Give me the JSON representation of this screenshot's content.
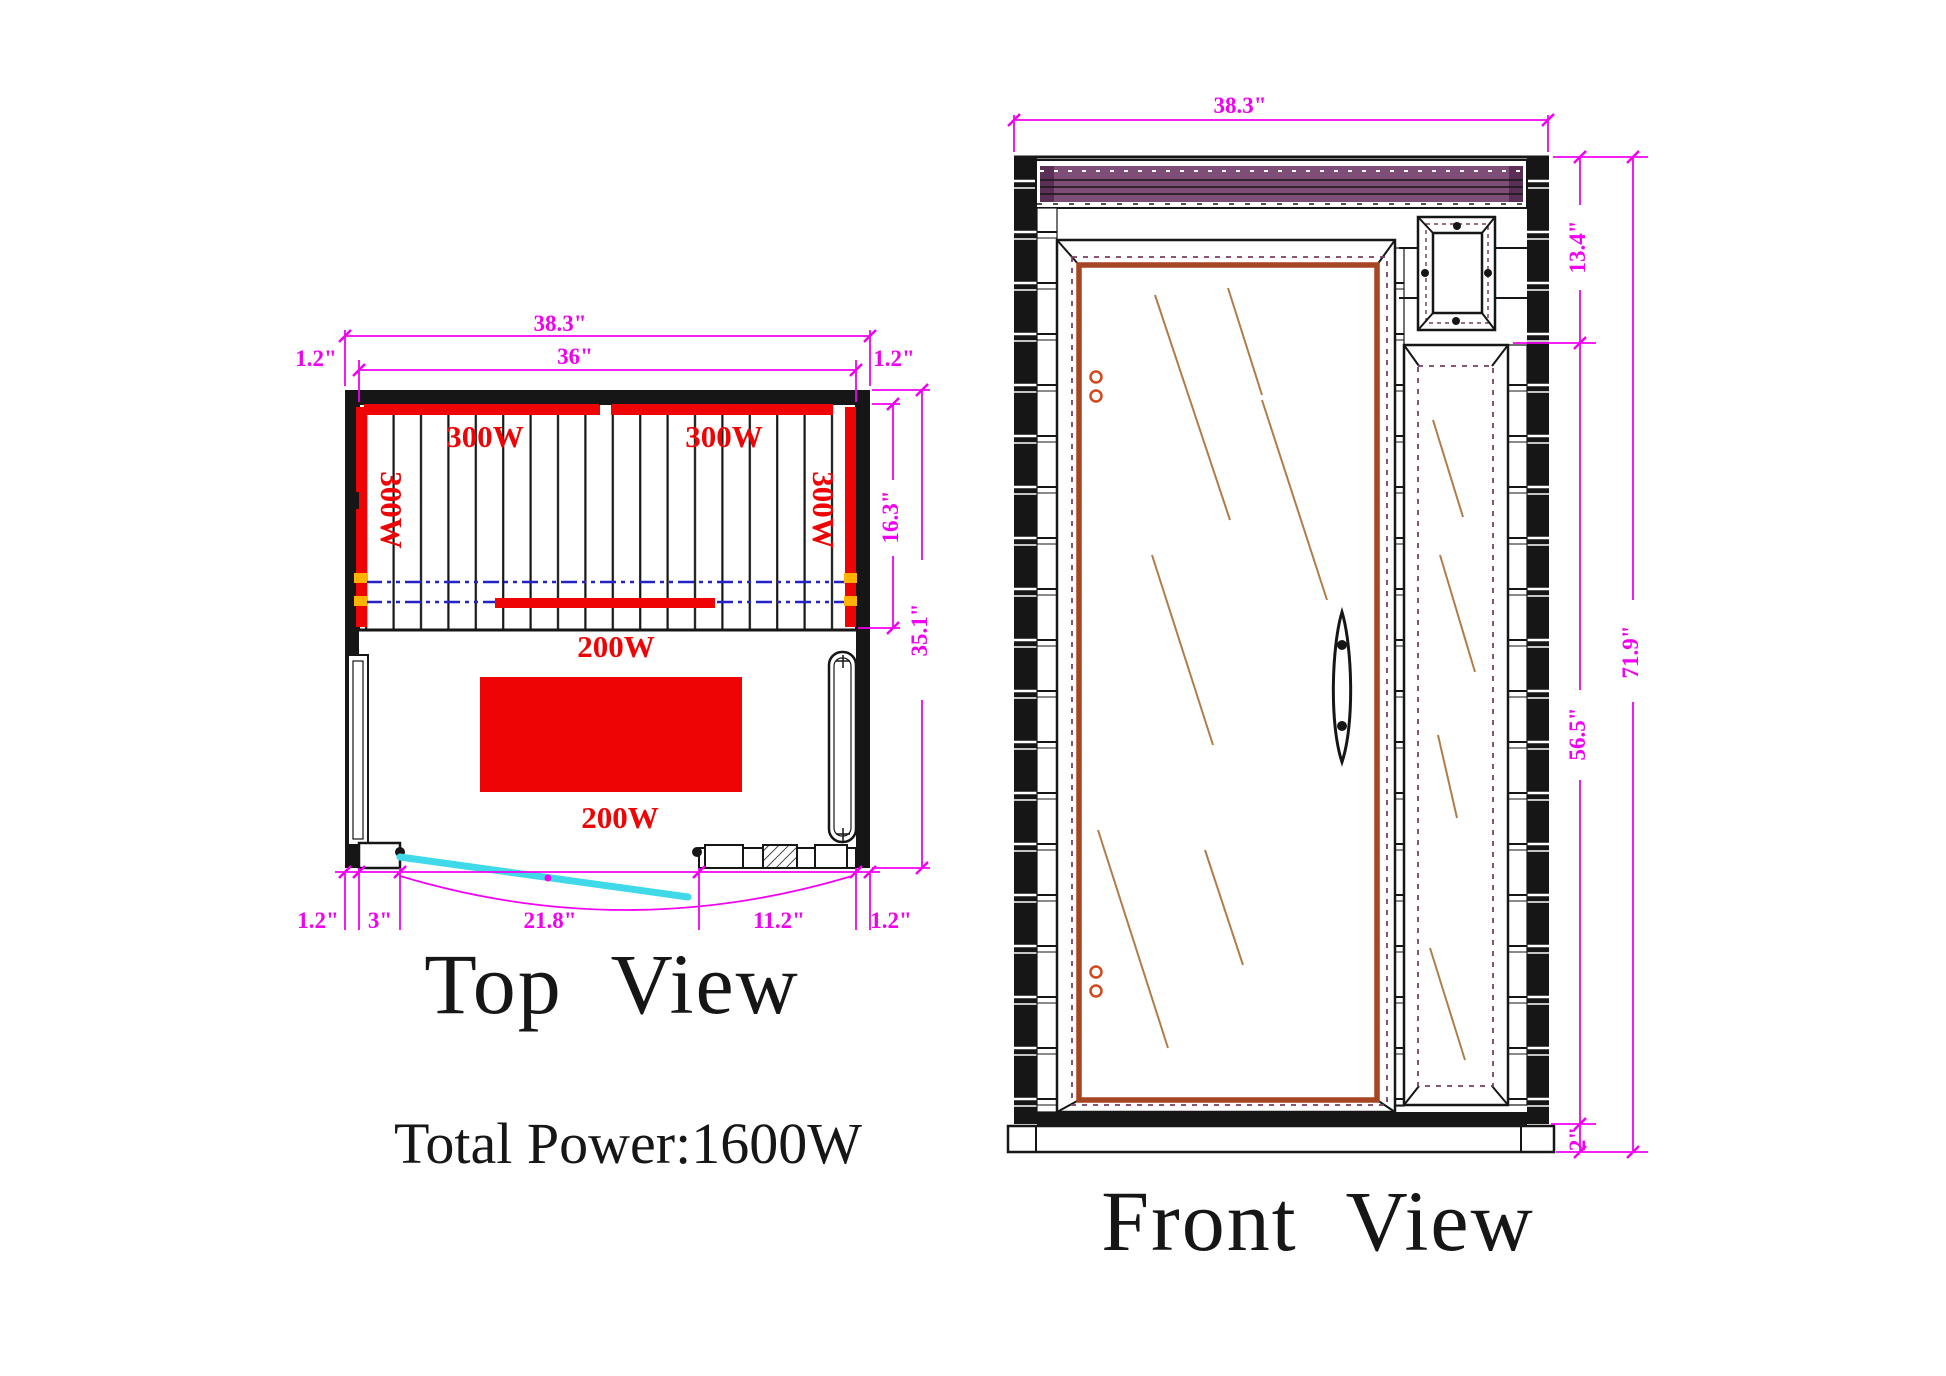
{
  "top_view": {
    "title": "Top View",
    "dimensions": {
      "overall_width": "38.3\"",
      "interior_width": "36\"",
      "left_wall": "1.2\"",
      "right_wall": "1.2\"",
      "heater_zone_depth": "16.3\"",
      "interior_depth": "35.1\"",
      "bottom_left_wall": "1.2\"",
      "door_jamb": "3\"",
      "door_opening": "21.8\"",
      "front_panel": "11.2\"",
      "bottom_right_wall": "1.2\""
    },
    "heaters": {
      "back_left": "300W",
      "back_right": "300W",
      "side_left": "300W",
      "side_right": "300W",
      "mid": "200W",
      "bench": "200W"
    }
  },
  "front_view": {
    "title": "Front View",
    "dimensions": {
      "overall_width": "38.3\"",
      "top_section_height": "13.4\"",
      "door_section_height": "56.5\"",
      "base_height": "2\"",
      "overall_height": "71.9\""
    }
  },
  "summary": {
    "total_power": "Total Power:1600W"
  },
  "colors": {
    "line_black": "#161616",
    "dim_magenta": "#F200F2",
    "heater_red": "#EE0404",
    "bench_line_blue": "#2323C8",
    "door_swing_cyan": "#3FD9EA",
    "vent_purple": "#7E4E78",
    "vent_purple_dark": "#5C2F56",
    "glass_frame_rust": "#A64523",
    "seal_maroon": "#7B3F63",
    "reflection_brown": "#B17C4B",
    "hinge_orange": "#D2491F",
    "heater_clip_orange": "#FFB300"
  }
}
